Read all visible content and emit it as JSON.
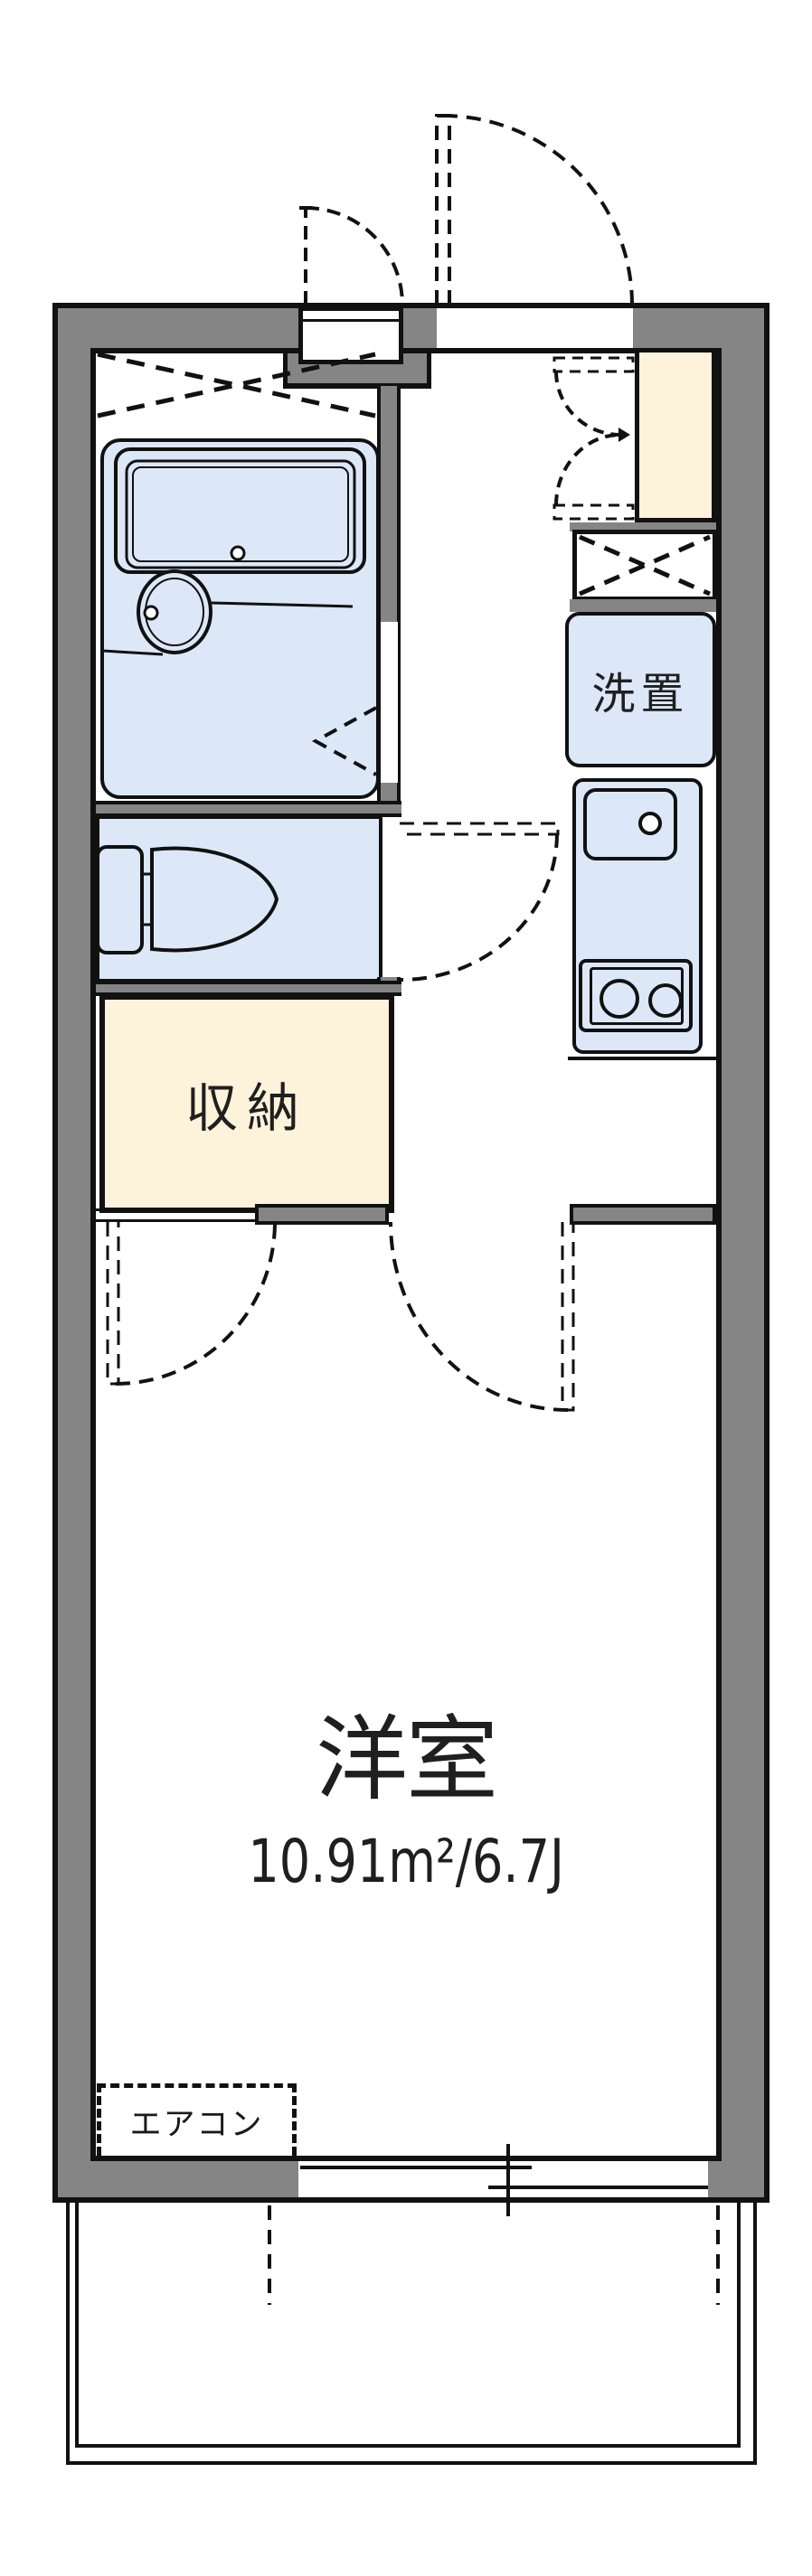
{
  "plan": {
    "labels": {
      "main_room": "洋室",
      "main_room_area": "10.91m²/6.7J",
      "storage": "収納",
      "laundry": "洗置",
      "aircon": "エアコン"
    },
    "colors": {
      "wall_gray": "#858585",
      "line_black": "#111111",
      "wet_area_blue": "#dce8f8",
      "storage_cream": "#fdf2da",
      "floor_white": "#ffffff"
    }
  }
}
